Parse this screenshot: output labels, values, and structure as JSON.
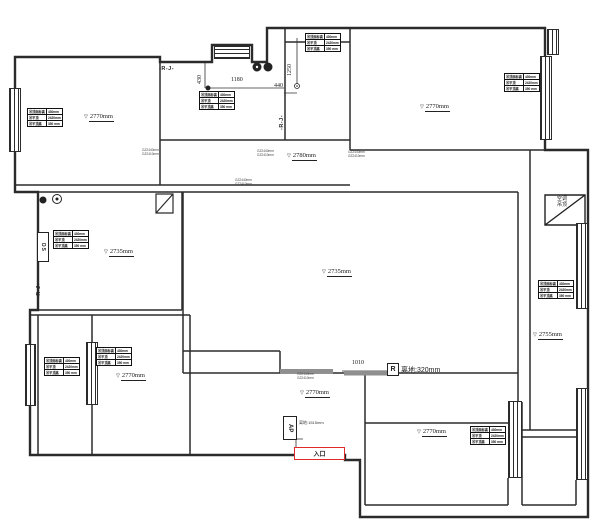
{
  "plan": {
    "colors": {
      "wall": "#2b2b2b",
      "entrance_red": "#e02b2b",
      "gray_wall": "#8f8f8f"
    },
    "dims": {
      "v430": "430",
      "h1180": "1180",
      "h440": "440",
      "v1250": "1250",
      "h1010": "1010"
    },
    "labels": {
      "rj": "-R-J-",
      "r_letter": "R",
      "floor_clearance": "离地:320mm",
      "entrance": "入口",
      "ap": "AP",
      "ac_line1": "空调",
      "ac_line2": "吊顶",
      "ds": "DS",
      "clearance_small": "离地:1515mm"
    },
    "wall_note": {
      "line1": "GZ2440mm",
      "line2": "GZ2410mm"
    },
    "note_positions": [
      {
        "x": 142,
        "y": 149
      },
      {
        "x": 235,
        "y": 179
      },
      {
        "x": 257,
        "y": 150
      },
      {
        "x": 348,
        "y": 151
      },
      {
        "x": 297,
        "y": 373
      }
    ],
    "info_table": {
      "rows": [
        [
          "吊顶面标高",
          "430mm"
        ],
        [
          "吊平顶",
          "2420mm"
        ],
        [
          "吊平顶高",
          "350 mm"
        ]
      ]
    },
    "table_positions": [
      {
        "x": 27,
        "y": 108
      },
      {
        "x": 199,
        "y": 91
      },
      {
        "x": 305,
        "y": 33
      },
      {
        "x": 504,
        "y": 73
      },
      {
        "x": 53,
        "y": 230
      },
      {
        "x": 538,
        "y": 280
      },
      {
        "x": 44,
        "y": 357
      },
      {
        "x": 96,
        "y": 347
      },
      {
        "x": 470,
        "y": 426
      }
    ],
    "elevation_labels": [
      {
        "text": "2770mm",
        "x": 84,
        "y": 113
      },
      {
        "text": "2770mm",
        "x": 420,
        "y": 103
      },
      {
        "text": "2780mm",
        "x": 287,
        "y": 152
      },
      {
        "text": "2735mm",
        "x": 104,
        "y": 248
      },
      {
        "text": "2735mm",
        "x": 322,
        "y": 268
      },
      {
        "text": "2770mm",
        "x": 116,
        "y": 372
      },
      {
        "text": "2770mm",
        "x": 300,
        "y": 389
      },
      {
        "text": "2770mm",
        "x": 417,
        "y": 428
      },
      {
        "text": "2755mm",
        "x": 533,
        "y": 331
      }
    ],
    "windows": [
      {
        "x": 9,
        "y": 88,
        "w": 12,
        "h": 64,
        "o": "v"
      },
      {
        "x": 214,
        "y": 46,
        "w": 36,
        "h": 13,
        "o": "h"
      },
      {
        "x": 540,
        "y": 56,
        "w": 12,
        "h": 84,
        "o": "v"
      },
      {
        "x": 547,
        "y": 29,
        "w": 12,
        "h": 26,
        "o": "v"
      },
      {
        "x": 576,
        "y": 223,
        "w": 12,
        "h": 86,
        "o": "v"
      },
      {
        "x": 576,
        "y": 388,
        "w": 12,
        "h": 92,
        "o": "v"
      },
      {
        "x": 86,
        "y": 342,
        "w": 12,
        "h": 63,
        "o": "v"
      },
      {
        "x": 25,
        "y": 344,
        "w": 11,
        "h": 62,
        "o": "v"
      },
      {
        "x": 508,
        "y": 401,
        "w": 14,
        "h": 77,
        "o": "v"
      }
    ]
  }
}
